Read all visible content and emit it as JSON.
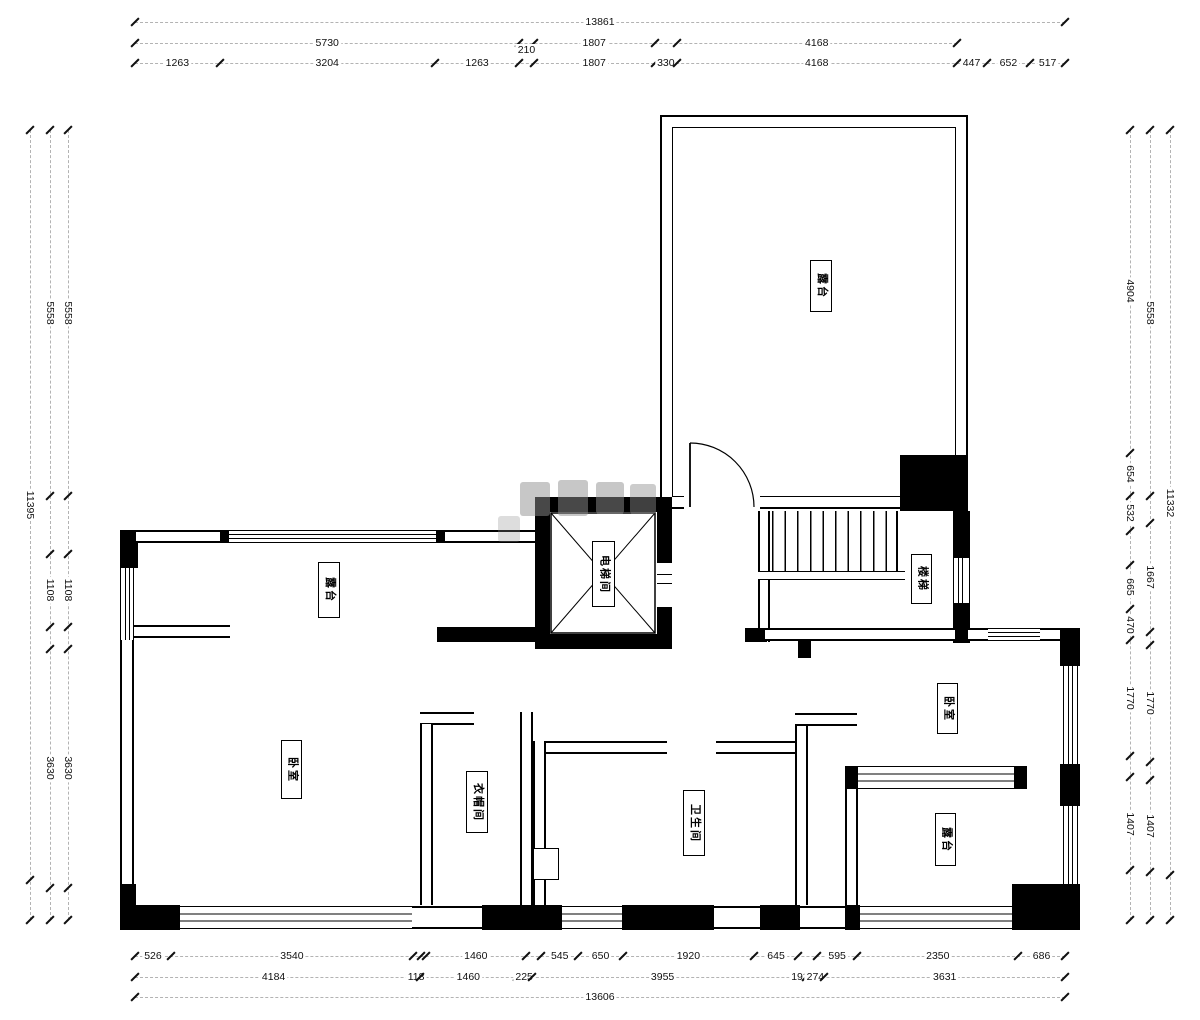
{
  "rooms": {
    "terrace_top": "露台",
    "terrace_left": "露台",
    "terrace_bottom": "露台",
    "bedroom_left": "卧室",
    "bedroom_right": "卧室",
    "closet": "衣帽间",
    "bathroom": "卫生间",
    "elevator": "电梯间",
    "stairs": "楼梯"
  },
  "dimensions": {
    "top": {
      "ref": 13861,
      "rows": [
        [
          {
            "label": "13861",
            "mm": 13861
          }
        ],
        [
          {
            "label": "5730",
            "mm": 5730
          },
          {
            "label": "",
            "mm": 210
          },
          {
            "label": "1807",
            "mm": 1807
          },
          {
            "label": "",
            "mm": 330
          },
          {
            "label": "4168",
            "mm": 4168
          }
        ],
        [
          {
            "label": "1263",
            "mm": 1263
          },
          {
            "label": "3204",
            "mm": 3204
          },
          {
            "label": "1263",
            "mm": 1263
          },
          {
            "label": "210",
            "mm": 210,
            "offset": true
          },
          {
            "label": "1807",
            "mm": 1807
          },
          {
            "label": "330",
            "mm": 330
          },
          {
            "label": "4168",
            "mm": 4168
          },
          {
            "label": "447",
            "mm": 447
          },
          {
            "label": "652",
            "mm": 652
          },
          {
            "label": "517",
            "mm": 517
          }
        ]
      ]
    },
    "bottom": {
      "ref": 13606,
      "rows": [
        [
          {
            "label": "526",
            "mm": 526
          },
          {
            "label": "3540",
            "mm": 3540
          },
          {
            "label": "",
            "mm": 118
          },
          {
            "label": "",
            "mm": 72
          },
          {
            "label": "1460",
            "mm": 1460
          },
          {
            "label": "",
            "mm": 225
          },
          {
            "label": "545",
            "mm": 545
          },
          {
            "label": "650",
            "mm": 650
          },
          {
            "label": "1920",
            "mm": 1920
          },
          {
            "label": "645",
            "mm": 645
          },
          {
            "label": "",
            "mm": 274
          },
          {
            "label": "595",
            "mm": 595
          },
          {
            "label": "2350",
            "mm": 2350
          },
          {
            "label": "686",
            "mm": 686
          }
        ],
        [
          {
            "label": "4184",
            "mm": 4184
          },
          {
            "label": "118",
            "mm": 118
          },
          {
            "label": "1460",
            "mm": 1460
          },
          {
            "label": "225",
            "mm": 225
          },
          {
            "label": "3955",
            "mm": 3955
          },
          {
            "label": "192",
            "mm": 192
          },
          {
            "label": "274",
            "mm": 274
          },
          {
            "label": "3631",
            "mm": 3631
          }
        ],
        [
          {
            "label": "13606",
            "mm": 13606
          }
        ]
      ]
    },
    "left": {
      "ref": 12006,
      "rows": [
        [
          {
            "label": "11395",
            "mm": 11395
          },
          {
            "label": "",
            "mm": 610
          }
        ],
        [
          {
            "label": "5558",
            "mm": 5558
          },
          {
            "label": "",
            "mm": 885
          },
          {
            "label": "1108",
            "mm": 1108
          },
          {
            "label": "",
            "mm": 335
          },
          {
            "label": "3630",
            "mm": 3630
          },
          {
            "label": "",
            "mm": 490
          }
        ],
        [
          {
            "label": "5558",
            "mm": 5558
          },
          {
            "label": "",
            "mm": 885
          },
          {
            "label": "1108",
            "mm": 1108
          },
          {
            "label": "",
            "mm": 335
          },
          {
            "label": "3630",
            "mm": 3630
          },
          {
            "label": "",
            "mm": 490
          }
        ]
      ]
    },
    "right": {
      "ref": 12012,
      "rows": [
        [
          {
            "label": "4904",
            "mm": 4904
          },
          {
            "label": "654",
            "mm": 654
          },
          {
            "label": "532",
            "mm": 532
          },
          {
            "label": "",
            "mm": 530
          },
          {
            "label": "665",
            "mm": 665
          },
          {
            "label": "470",
            "mm": 470
          },
          {
            "label": "1770",
            "mm": 1770
          },
          {
            "label": "",
            "mm": 320
          },
          {
            "label": "1407",
            "mm": 1407
          },
          {
            "label": "",
            "mm": 760
          }
        ],
        [
          {
            "label": "5558",
            "mm": 5558
          },
          {
            "label": "",
            "mm": 410
          },
          {
            "label": "1667",
            "mm": 1667
          },
          {
            "label": "",
            "mm": 200
          },
          {
            "label": "1770",
            "mm": 1770
          },
          {
            "label": "",
            "mm": 275
          },
          {
            "label": "1407",
            "mm": 1407
          },
          {
            "label": "",
            "mm": 725
          }
        ],
        [
          {
            "label": "11332",
            "mm": 11332
          },
          {
            "label": "",
            "mm": 680
          }
        ]
      ]
    },
    "colors": {
      "wall": "#000000",
      "dash": "#b3b3b3",
      "text": "#111111"
    }
  }
}
